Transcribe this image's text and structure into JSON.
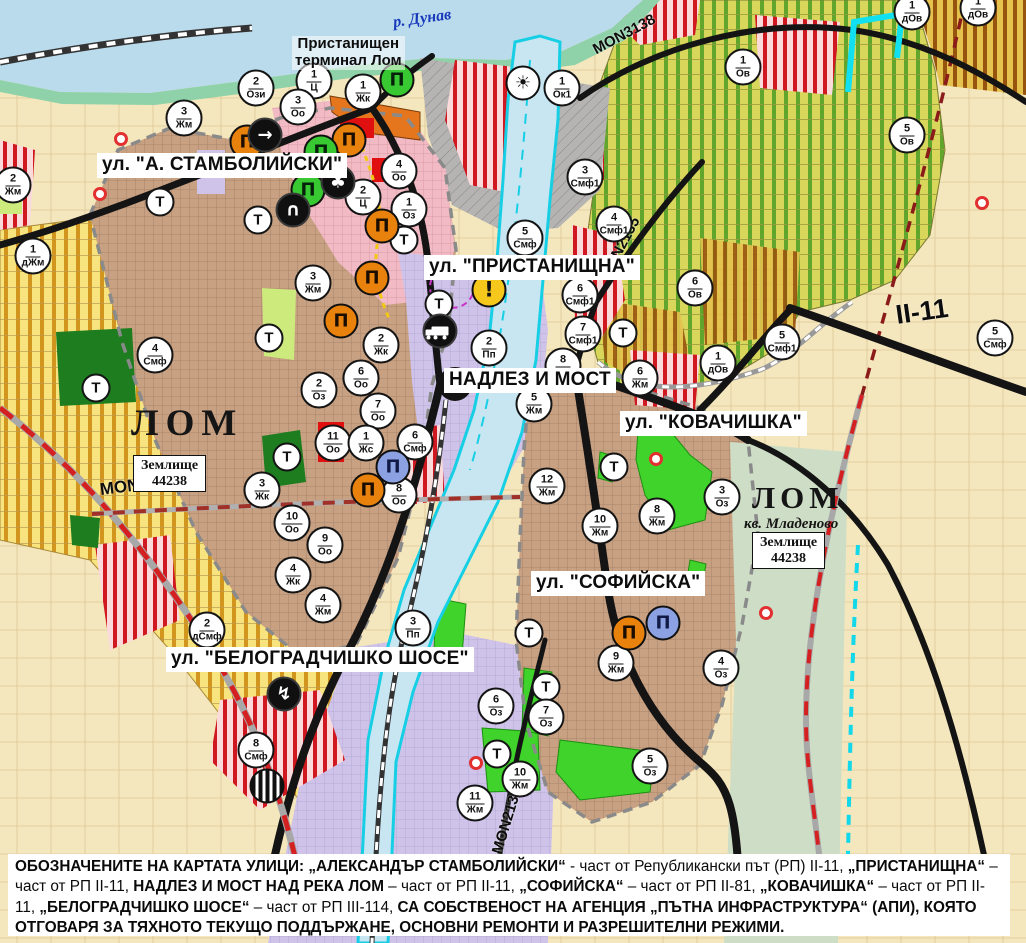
{
  "map": {
    "street_labels": [
      {
        "id": "stambolijski",
        "text": "ул. \"А. СТАМБОЛИЙСКИ\"",
        "x": 97,
        "y": 153,
        "fs": 19
      },
      {
        "id": "pristanishtna",
        "text": "ул. \"ПРИСТАНИЩНА\"",
        "x": 424,
        "y": 255,
        "fs": 19
      },
      {
        "id": "nadlez-i-most",
        "text": "НАДЛЕЗ И МОСТ",
        "x": 444,
        "y": 368,
        "fs": 19
      },
      {
        "id": "kovachishka",
        "text": "ул. \"КОВАЧИШКА\"",
        "x": 620,
        "y": 411,
        "fs": 19
      },
      {
        "id": "sofiyska",
        "text": "ул. \"СОФИЙСКА\"",
        "x": 531,
        "y": 571,
        "fs": 19
      },
      {
        "id": "belogradchishko-shose",
        "text": "ул. \"БЕЛОГРАДЧИШКО ШОСЕ\"",
        "x": 166,
        "y": 647,
        "fs": 19
      }
    ],
    "road_labels": [
      {
        "id": "mon3138",
        "text": "MON3138",
        "x": 594,
        "y": 42,
        "fs": 15,
        "rot": -28
      },
      {
        "id": "mon2135",
        "text": "MON2135",
        "x": 604,
        "y": 270,
        "fs": 15,
        "rot": -62
      },
      {
        "id": "mon3139",
        "text": "MON3139",
        "x": 100,
        "y": 480,
        "fs": 17,
        "rot": -7
      },
      {
        "id": "mon2136",
        "text": "MON2136",
        "x": 497,
        "y": 845,
        "fs": 15,
        "rot": -73
      },
      {
        "id": "ii-11",
        "text": "II-11",
        "x": 896,
        "y": 300,
        "fs": 27,
        "rot": -8
      }
    ],
    "place_labels": {
      "danube": "р. Дунав",
      "terminal_line1": "Пристанищен",
      "terminal_line2": "терминал Лом",
      "lom_west": "ЛОМ",
      "lom_east": "ЛОМ",
      "kv_mladenovo": "кв. Младеново",
      "zemlishte_line1": "Землище",
      "zemlishte_line2": "44238"
    },
    "t_label": "Т",
    "zone_markers": [
      {
        "n": "2",
        "c": "Ози",
        "x": 256,
        "y": 88
      },
      {
        "n": "1",
        "c": "Ц",
        "x": 314,
        "y": 81
      },
      {
        "n": "1",
        "c": "Жк",
        "x": 363,
        "y": 92
      },
      {
        "n": "3",
        "c": "Оо",
        "x": 298,
        "y": 107
      },
      {
        "n": "3",
        "c": "Жм",
        "x": 184,
        "y": 118
      },
      {
        "n": "2",
        "c": "Жм",
        "x": 13,
        "y": 185
      },
      {
        "n": "1",
        "c": "дЖм",
        "x": 33,
        "y": 256
      },
      {
        "n": "4",
        "c": "Оо",
        "x": 399,
        "y": 171
      },
      {
        "n": "2",
        "c": "Ц",
        "x": 363,
        "y": 197
      },
      {
        "n": "1",
        "c": "Оз",
        "x": 409,
        "y": 209
      },
      {
        "n": "4",
        "c": "Смф",
        "x": 155,
        "y": 355
      },
      {
        "n": "3",
        "c": "Жм",
        "x": 313,
        "y": 283
      },
      {
        "n": "2",
        "c": "Жк",
        "x": 381,
        "y": 345
      },
      {
        "n": "6",
        "c": "Оо",
        "x": 361,
        "y": 378
      },
      {
        "n": "2",
        "c": "Оз",
        "x": 319,
        "y": 390
      },
      {
        "n": "7",
        "c": "Оо",
        "x": 378,
        "y": 411
      },
      {
        "n": "11",
        "c": "Оо",
        "x": 333,
        "y": 443
      },
      {
        "n": "1",
        "c": "Жс",
        "x": 366,
        "y": 443
      },
      {
        "n": "6",
        "c": "Смф",
        "x": 415,
        "y": 442
      },
      {
        "n": "8",
        "c": "Оо",
        "x": 399,
        "y": 495
      },
      {
        "n": "3",
        "c": "Жк",
        "x": 262,
        "y": 490
      },
      {
        "n": "10",
        "c": "Оо",
        "x": 292,
        "y": 523
      },
      {
        "n": "9",
        "c": "Оо",
        "x": 325,
        "y": 545
      },
      {
        "n": "4",
        "c": "Жк",
        "x": 293,
        "y": 575
      },
      {
        "n": "4",
        "c": "Жм",
        "x": 323,
        "y": 605
      },
      {
        "n": "2",
        "c": "дСмф",
        "x": 207,
        "y": 630
      },
      {
        "n": "3",
        "c": "Пп",
        "x": 413,
        "y": 628
      },
      {
        "n": "8",
        "c": "Смф",
        "x": 256,
        "y": 750
      },
      {
        "n": "1",
        "c": "Ок1",
        "x": 562,
        "y": 88
      },
      {
        "n": "3",
        "c": "Смф1",
        "x": 585,
        "y": 177
      },
      {
        "n": "4",
        "c": "Смф1",
        "x": 614,
        "y": 224
      },
      {
        "n": "5",
        "c": "Смф",
        "x": 525,
        "y": 238
      },
      {
        "n": "6",
        "c": "Смф1",
        "x": 580,
        "y": 295
      },
      {
        "n": "7",
        "c": "Смф1",
        "x": 583,
        "y": 334
      },
      {
        "n": "2",
        "c": "Пп",
        "x": 489,
        "y": 348
      },
      {
        "n": "8",
        "c": "Жм",
        "x": 563,
        "y": 366
      },
      {
        "n": "5",
        "c": "Жм",
        "x": 534,
        "y": 404
      },
      {
        "n": "12",
        "c": "Жм",
        "x": 547,
        "y": 486
      },
      {
        "n": "6",
        "c": "Жм",
        "x": 640,
        "y": 378
      },
      {
        "n": "8",
        "c": "Жм",
        "x": 657,
        "y": 516
      },
      {
        "n": "10",
        "c": "Жм",
        "x": 600,
        "y": 526
      },
      {
        "n": "3",
        "c": "Оз",
        "x": 722,
        "y": 497
      },
      {
        "n": "9",
        "c": "Жм",
        "x": 616,
        "y": 663
      },
      {
        "n": "4",
        "c": "Оз",
        "x": 721,
        "y": 668
      },
      {
        "n": "6",
        "c": "Оз",
        "x": 496,
        "y": 706
      },
      {
        "n": "7",
        "c": "Оз",
        "x": 546,
        "y": 717
      },
      {
        "n": "5",
        "c": "Оз",
        "x": 650,
        "y": 766
      },
      {
        "n": "10",
        "c": "Жм",
        "x": 520,
        "y": 779
      },
      {
        "n": "11",
        "c": "Жм",
        "x": 475,
        "y": 803
      },
      {
        "n": "1",
        "c": "Ов",
        "x": 743,
        "y": 67
      },
      {
        "n": "1",
        "c": "дОв",
        "x": 912,
        "y": 12
      },
      {
        "n": "5",
        "c": "Ов",
        "x": 907,
        "y": 135
      },
      {
        "n": "6",
        "c": "Ов",
        "x": 695,
        "y": 288
      },
      {
        "n": "5",
        "c": "Смф1",
        "x": 782,
        "y": 342
      },
      {
        "n": "1",
        "c": "дОв",
        "x": 718,
        "y": 363
      },
      {
        "n": "5",
        "c": "Смф",
        "x": 995,
        "y": 338
      },
      {
        "n": "1",
        "c": "дОв",
        "x": 978,
        "y": 8
      }
    ],
    "t_markers": [
      {
        "x": 160,
        "y": 202
      },
      {
        "x": 258,
        "y": 220
      },
      {
        "x": 269,
        "y": 338
      },
      {
        "x": 96,
        "y": 388
      },
      {
        "x": 287,
        "y": 457
      },
      {
        "x": 404,
        "y": 240
      },
      {
        "x": 439,
        "y": 304
      },
      {
        "x": 623,
        "y": 333
      },
      {
        "x": 614,
        "y": 467
      },
      {
        "x": 529,
        "y": 633
      },
      {
        "x": 546,
        "y": 687
      },
      {
        "x": 497,
        "y": 754
      }
    ],
    "icon_glyphs": {
      "mon-orange": "Π",
      "mon-green": "Π",
      "mon-blue": "Π",
      "club": "♣",
      "tunnel": "∩",
      "arrow": "→",
      "lightning": "↯",
      "sun": "☀",
      "warning": "!",
      "truck": "",
      "station": ""
    },
    "icons": [
      {
        "t": "mon-orange",
        "x": 247,
        "y": 142
      },
      {
        "t": "mon-orange",
        "x": 349,
        "y": 140
      },
      {
        "t": "mon-orange",
        "x": 382,
        "y": 226
      },
      {
        "t": "mon-orange",
        "x": 372,
        "y": 278
      },
      {
        "t": "mon-orange",
        "x": 341,
        "y": 321
      },
      {
        "t": "mon-orange",
        "x": 368,
        "y": 490
      },
      {
        "t": "mon-orange",
        "x": 629,
        "y": 633
      },
      {
        "t": "mon-green",
        "x": 397,
        "y": 80
      },
      {
        "t": "mon-green",
        "x": 321,
        "y": 152
      },
      {
        "t": "mon-green",
        "x": 308,
        "y": 190
      },
      {
        "t": "mon-blue",
        "x": 393,
        "y": 467
      },
      {
        "t": "mon-blue",
        "x": 663,
        "y": 623
      },
      {
        "t": "club",
        "x": 338,
        "y": 182
      },
      {
        "t": "tunnel",
        "x": 293,
        "y": 210
      },
      {
        "t": "arrow",
        "x": 265,
        "y": 135
      },
      {
        "t": "truck",
        "x": 440,
        "y": 331
      },
      {
        "t": "lightning",
        "x": 284,
        "y": 694
      },
      {
        "t": "station",
        "x": 267,
        "y": 786
      },
      {
        "t": "sun",
        "x": 523,
        "y": 83
      },
      {
        "t": "warning",
        "x": 489,
        "y": 290
      }
    ],
    "red_dots": [
      {
        "x": 121,
        "y": 139
      },
      {
        "x": 100,
        "y": 194
      },
      {
        "x": 315,
        "y": 190
      },
      {
        "x": 656,
        "y": 459
      },
      {
        "x": 982,
        "y": 203
      },
      {
        "x": 476,
        "y": 763
      },
      {
        "x": 766,
        "y": 613
      }
    ],
    "caption_segments": [
      {
        "b": 1,
        "t": "ОБОЗНАЧЕНИТЕ НА КАРТАТА УЛИЦИ: „АЛЕКСАНДЪР СТАМБОЛИЙСКИ“"
      },
      {
        "b": 0,
        "t": " - част от Републикански път (РП) II-11, "
      },
      {
        "b": 1,
        "t": "„ПРИСТАНИЩНА“"
      },
      {
        "b": 0,
        "t": " – част от РП II-11, "
      },
      {
        "b": 1,
        "t": "НАДЛЕЗ И МОСТ НАД РЕКА ЛОМ"
      },
      {
        "b": 0,
        "t": " – част от РП II-11, "
      },
      {
        "b": 1,
        "t": "„СОФИЙСКА“"
      },
      {
        "b": 0,
        "t": " – част от РП II-81, "
      },
      {
        "b": 1,
        "t": "„КОВАЧИШКА“"
      },
      {
        "b": 0,
        "t": " – част от РП II-11, "
      },
      {
        "b": 1,
        "t": "„БЕЛОГРАДЧИШКО ШОСЕ“"
      },
      {
        "b": 0,
        "t": " – част от РП III-114, "
      },
      {
        "b": 1,
        "t": "СА СОБСТВЕНОСТ НА АГЕНЦИЯ „ПЪТНА ИНФРАСТРУКТУРА“ (АПИ), КОЯТО ОТГОВАРЯ ЗА ТЯХНОТО ТЕКУЩО ПОДДЪРЖАНЕ, ОСНОВНИ РЕМОНТИ И РАЗРЕШИТЕЛНИ РЕЖИМИ."
      }
    ],
    "colors": {
      "water": "#badbec",
      "lom_river_stroke": "#17cfe4",
      "urban": "#c8a183",
      "pink": "#f2bac4",
      "lavender": "#cfc3ea",
      "vineyard_green": "#61a52c",
      "agri_yellow": "#f8e47e",
      "agri_stripe": "#d2961f",
      "smf_red": "#cf1820",
      "park_green": "#3fd32b",
      "road_black": "#141414",
      "road_red_dash": "#d42020",
      "monument_orange": "#e8820c",
      "monument_green": "#38c832",
      "monument_blue": "#8ba1e2"
    }
  }
}
